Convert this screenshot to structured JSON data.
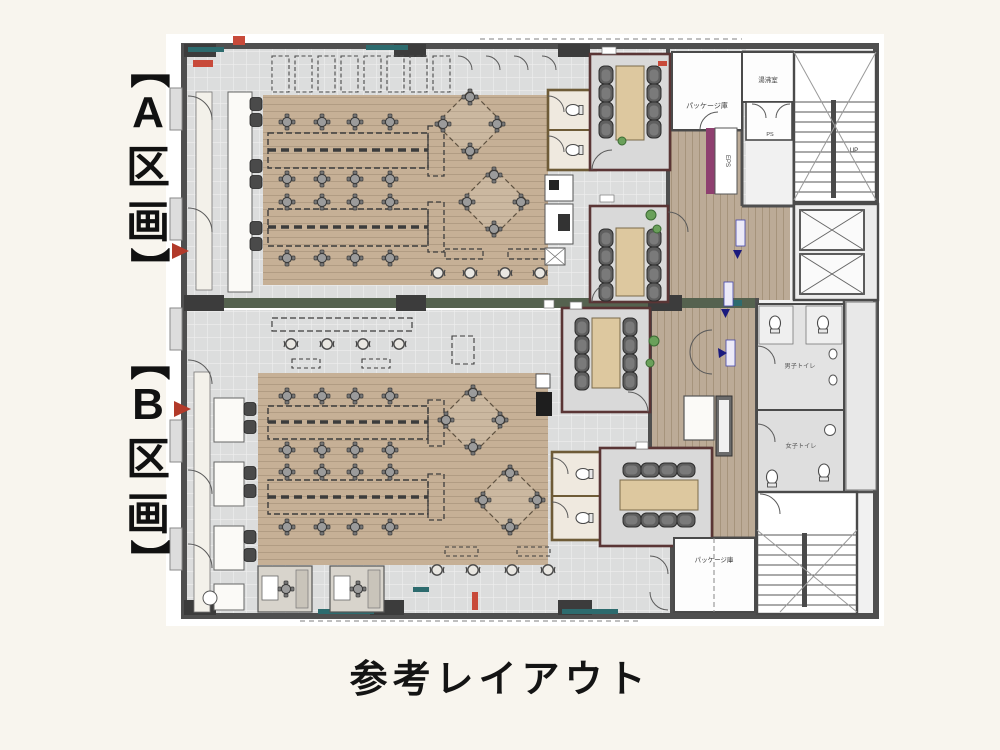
{
  "page": {
    "caption": "参考レイアウト",
    "background": "#f8f5ee"
  },
  "section_labels": {
    "a": [
      "【",
      "A",
      "区",
      "画",
      "】"
    ],
    "b": [
      "【",
      "B",
      "区",
      "画",
      "】"
    ]
  },
  "room_labels": {
    "package_top": "パッケージ庫",
    "kitchenette": "湯沸室",
    "stairs_up": "UP",
    "ps": "PS",
    "eps": "EPS",
    "mens_toilet": "男子トイレ",
    "womens_toilet": "女子トイレ",
    "package_bottom": "パッケージ庫"
  },
  "colors": {
    "wall": "#4f4f4f",
    "tile_floor": "#dcdddd",
    "wood_floor": "#c6b096",
    "corridor_wood": "#bcab97",
    "divider_green": "#55624f",
    "meeting_room_wall": "#5a3535",
    "table_wood": "#ddc89f",
    "chair_dark": "#5f5f5f",
    "wc_wall": "#6e5b37",
    "accent_teal": "#2d6b6e",
    "accent_red": "#b23a2a",
    "accent_blue": "#3b3bb0",
    "eps_purple": "#8e3f6f",
    "plant_green": "#6aa05a"
  }
}
